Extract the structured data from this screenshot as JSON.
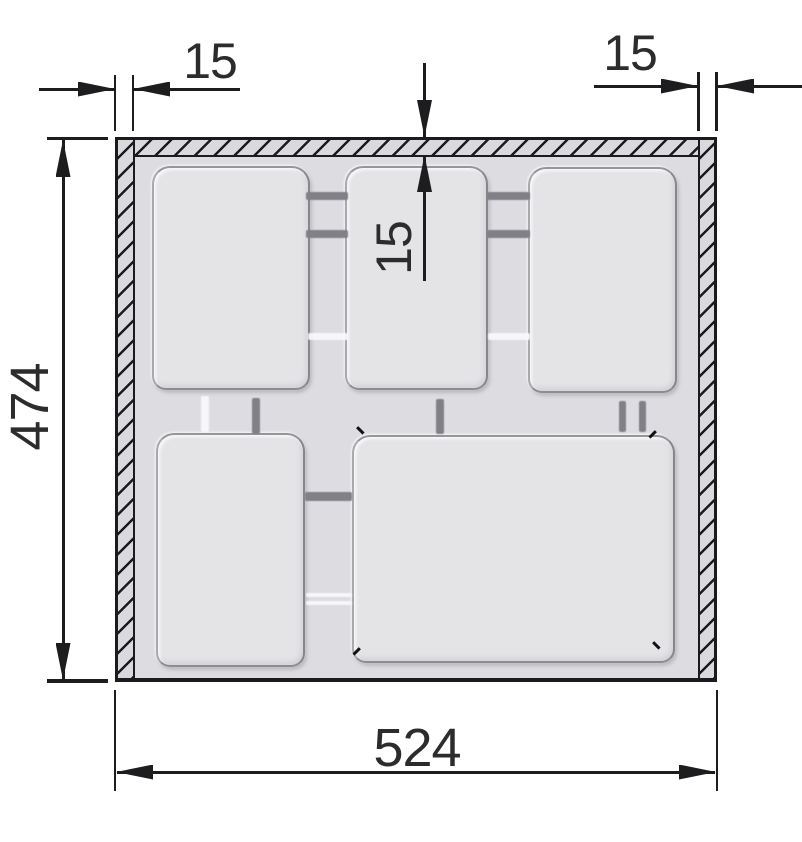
{
  "drawing": {
    "type": "cutlery-tray-insert top-view technical drawing",
    "compartment_count": 5,
    "dimensions": {
      "left_wall_thickness": "15",
      "right_wall_thickness": "15",
      "top_wall_thickness": "15",
      "overall_height": "474",
      "overall_width": "524"
    },
    "colors": {
      "outline": "#1b1b1d",
      "floor": "#dddde1",
      "compartment_fill": "#e4e4e7",
      "wall_fill": "#dadade",
      "notch": "#808086",
      "dimension_text": "#2c2c2f",
      "background": "#ffffff"
    }
  }
}
